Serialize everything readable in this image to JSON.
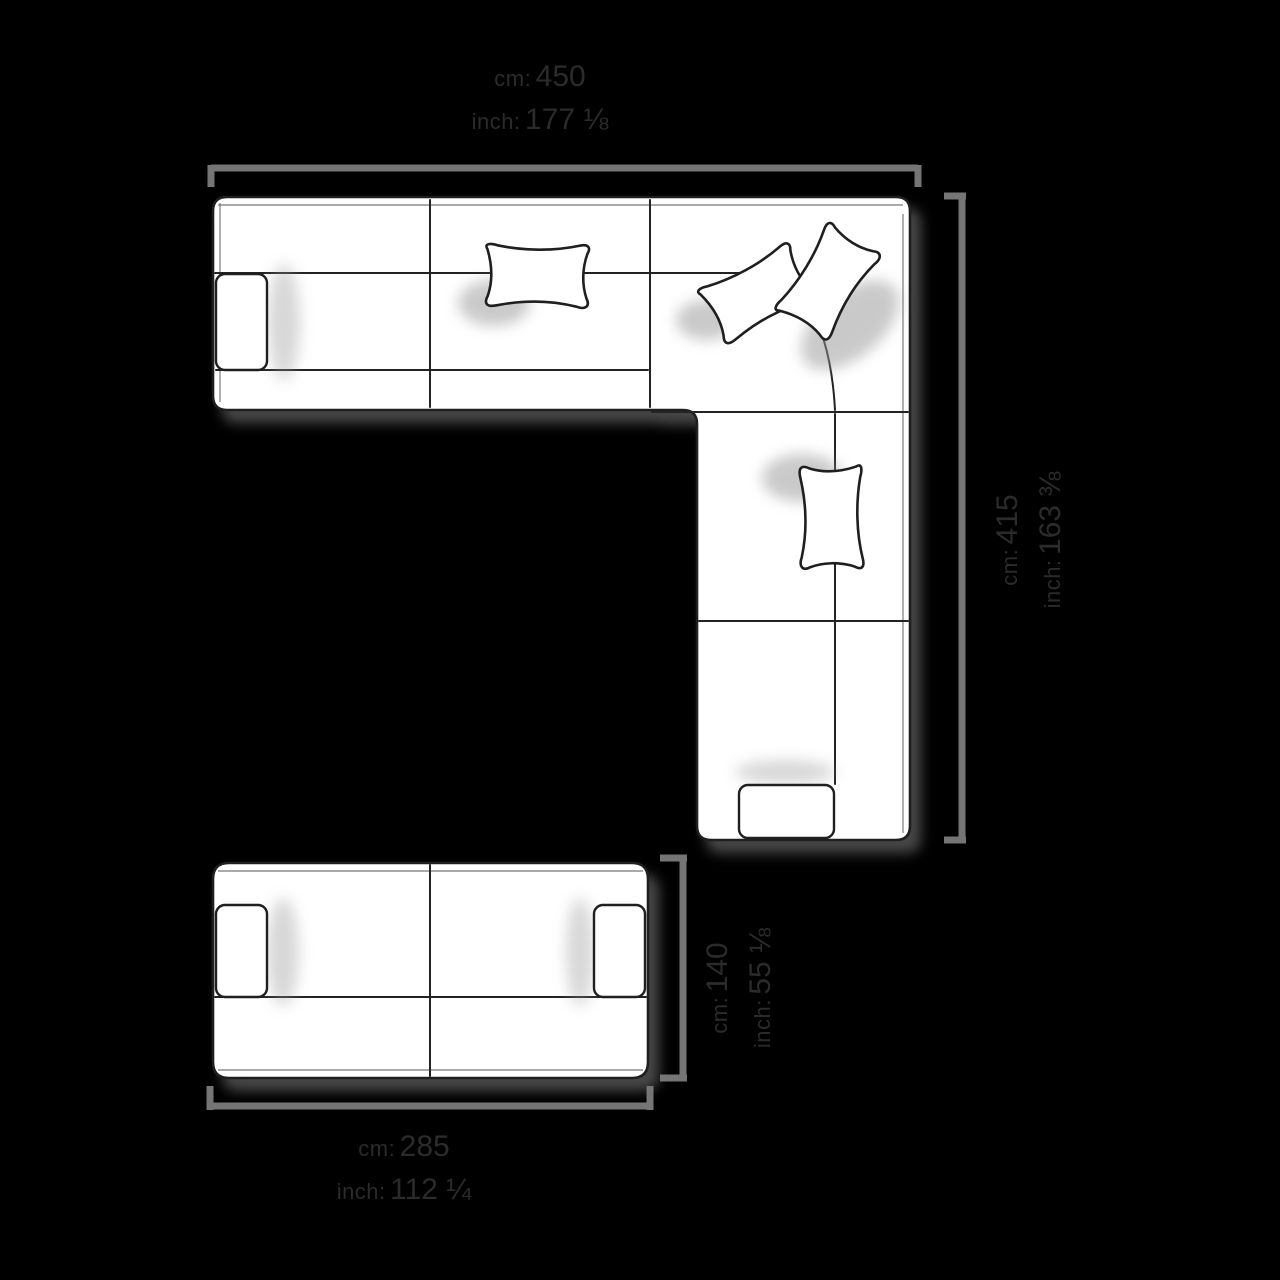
{
  "scene": {
    "title": "Sofa configuration top view with dimensions",
    "figures": [
      "corner-sectional-sofa-top-view",
      "two-seater-sofa-top-view"
    ]
  },
  "dimensions": {
    "sectional_width": {
      "cm_label": "cm:",
      "cm_value": "450",
      "inch_label": "inch:",
      "inch_value": "177 ⅛"
    },
    "sectional_depth": {
      "cm_label": "cm:",
      "cm_value": "415",
      "inch_label": "inch:",
      "inch_value": "163 ⅜"
    },
    "sofa_depth": {
      "cm_label": "cm:",
      "cm_value": "140",
      "inch_label": "inch:",
      "inch_value": "55 ⅛"
    },
    "sofa_width": {
      "cm_label": "cm:",
      "cm_value": "285",
      "inch_label": "inch:",
      "inch_value": "112 ¼"
    }
  },
  "colors": {
    "background": "#000000",
    "dimension_line": "#757575",
    "label_text": "#2b2b2b",
    "sofa_fill": "#ffffff",
    "sofa_outline": "#1f1f1f"
  }
}
